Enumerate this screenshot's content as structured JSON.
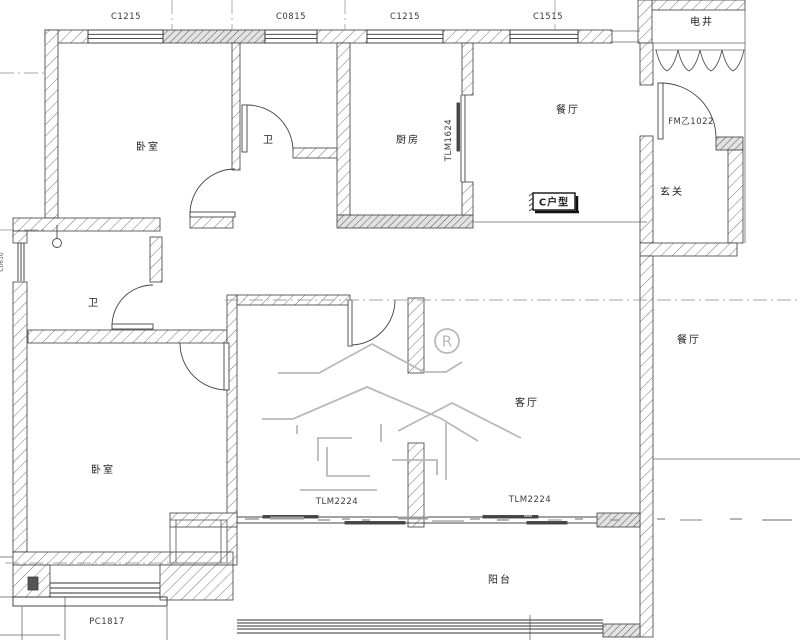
{
  "drawing": {
    "unit_type_label": "C户型",
    "registered_mark": "R",
    "rooms": {
      "bedroom_top": "卧室",
      "bath_top": "卫",
      "kitchen": "厨房",
      "dining": "餐厅",
      "utility_shaft": "电井",
      "entry": "玄关",
      "bath_left": "卫",
      "bedroom_bottom": "卧室",
      "living": "客厅",
      "balcony": "阳台",
      "dining_neighbor": "餐厅"
    },
    "openings": {
      "window_top_1": "C1215",
      "window_top_2": "C0815",
      "window_top_3": "C1215",
      "window_top_4": "C1515",
      "entry_door": "FM乙1022",
      "kitchen_sliding_door": "TLM1624",
      "balcony_sliding_door_left": "TLM2224",
      "balcony_sliding_door_right": "TLM2224",
      "bay_window": "PC1817",
      "side_window": "C0610"
    }
  }
}
